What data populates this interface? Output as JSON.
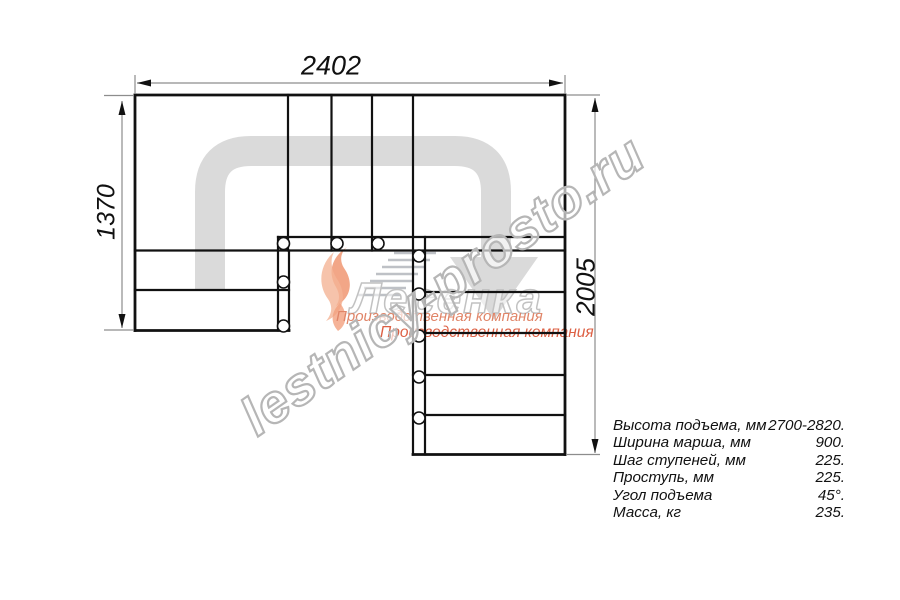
{
  "drawing": {
    "dimensions": {
      "width_top": "2402",
      "height_left": "1370",
      "height_right": "2005"
    },
    "watermark": "lestnicy-prosto.ru",
    "logo": {
      "name": "Лесенка",
      "tagline_1": "Производственная компания",
      "tagline_2": "Производственная компания"
    }
  },
  "specs": {
    "rows": [
      {
        "label": "Высота подъема, мм",
        "value": "2700-2820."
      },
      {
        "label": "Ширина марша, мм",
        "value": "900."
      },
      {
        "label": "Шаг ступеней, мм",
        "value": "225."
      },
      {
        "label": "Проступь, мм",
        "value": "225."
      },
      {
        "label": "Угол подъема",
        "value": "45°."
      },
      {
        "label": "Масса, кг",
        "value": "235."
      }
    ]
  }
}
